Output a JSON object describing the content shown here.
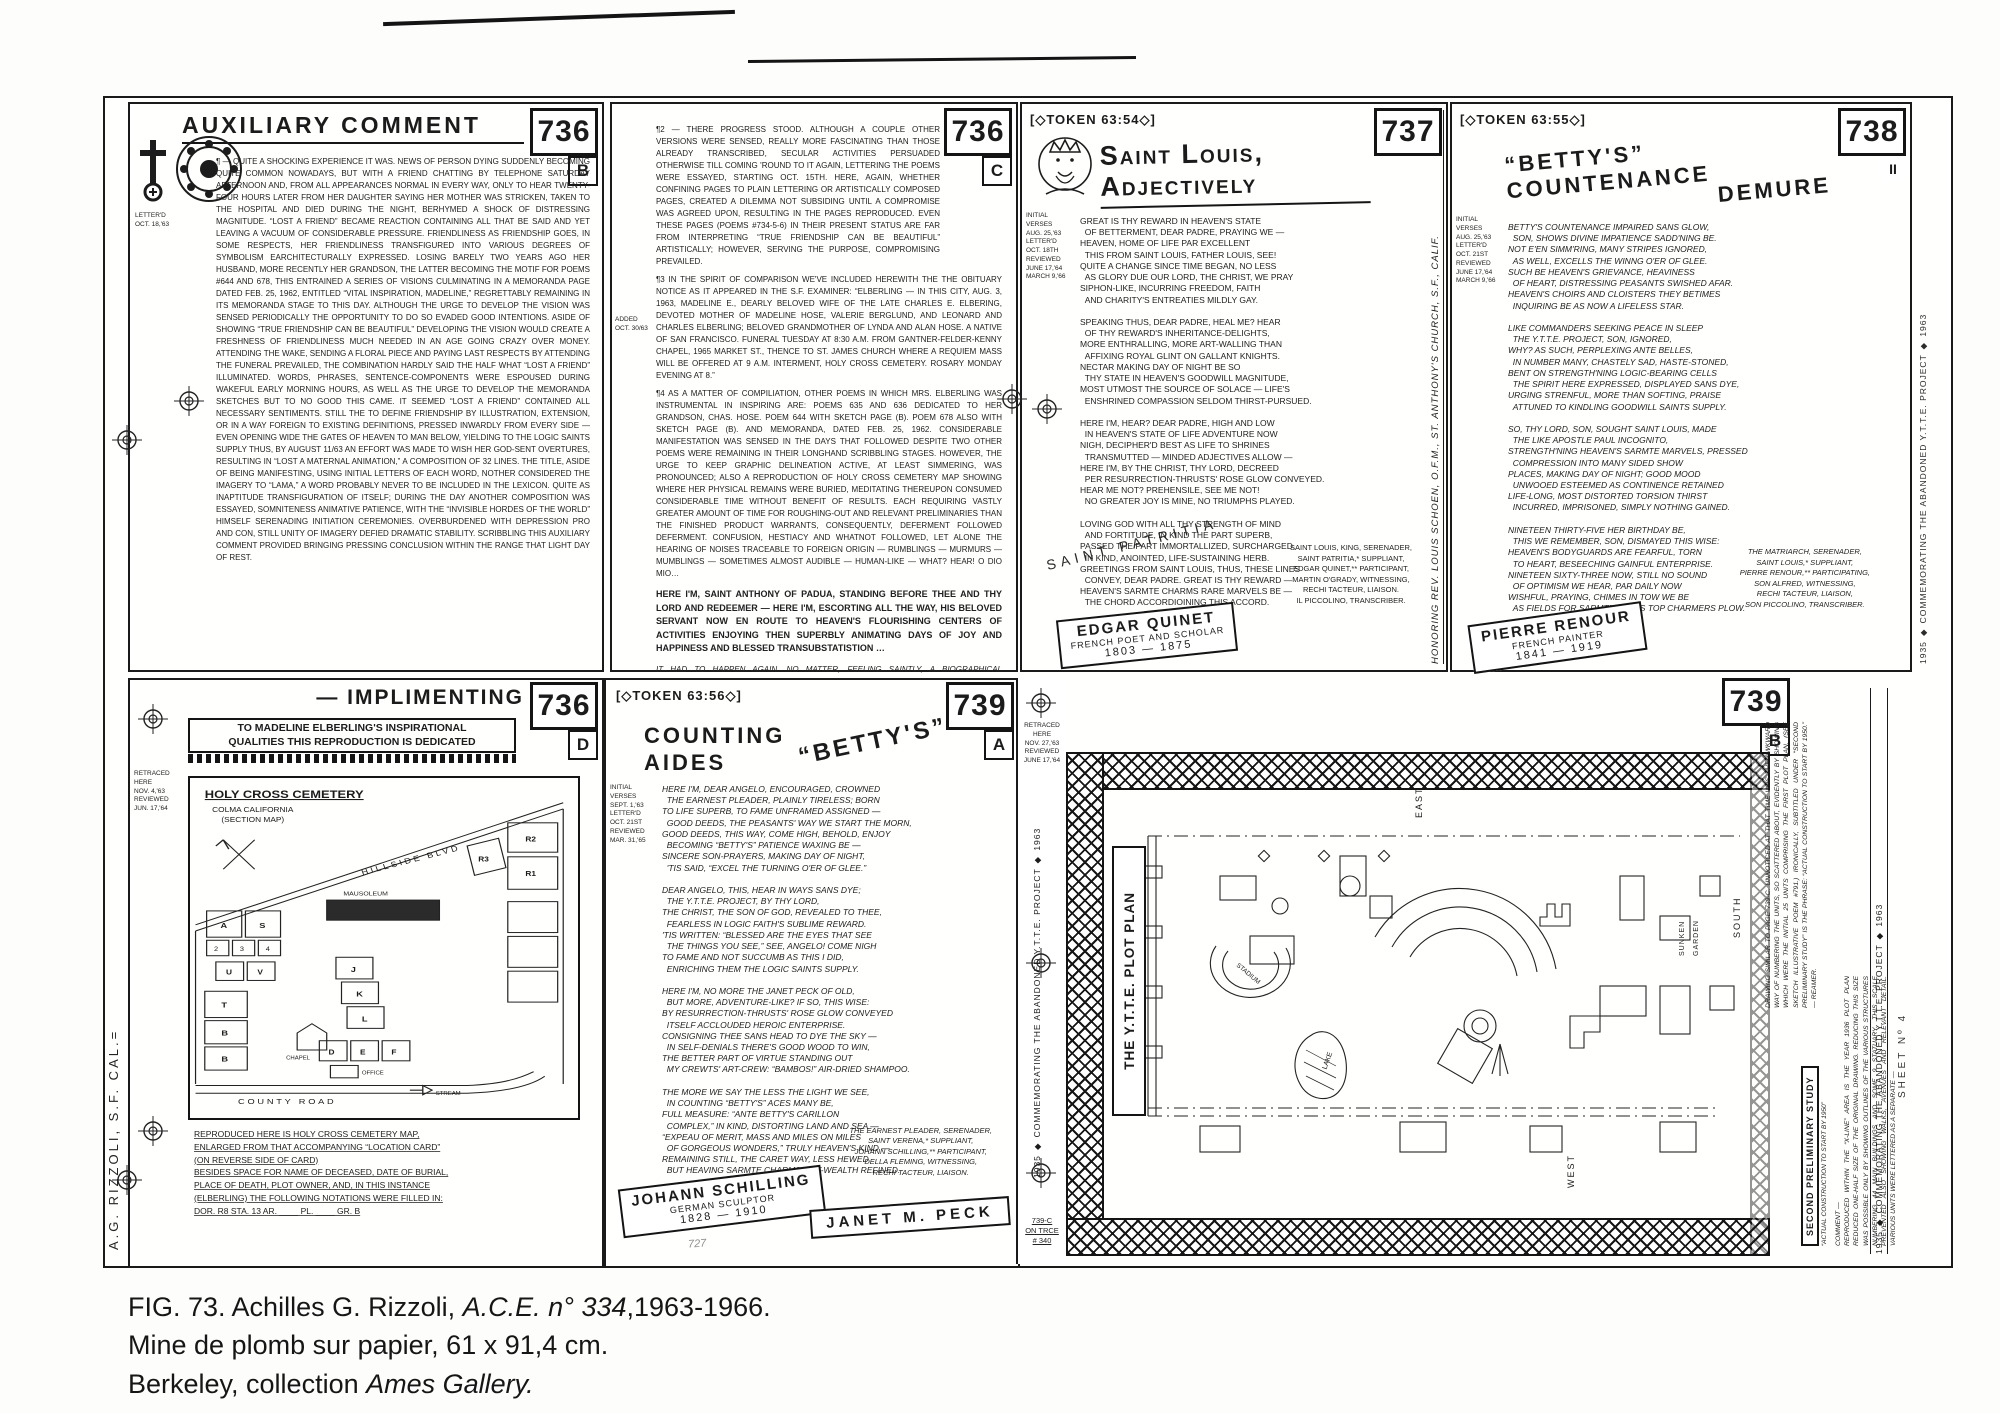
{
  "caption": {
    "line1_prefix": "FIG. 73. Achilles G. Rizzoli, ",
    "line1_italic": "A.C.E. n° 334",
    "line1_suffix": ",1963-1966.",
    "line2": "Mine de plomb sur papier, 61 x 91,4 cm.",
    "line3_prefix": "Berkeley, collection ",
    "line3_italic": "Ames Gallery."
  },
  "scan": {
    "artist_signature": "A.G. RIZZOLI, S.F. CAL.=",
    "pencil_note": "727"
  },
  "p736b": {
    "number": "736",
    "letter": "B",
    "title": "AUXILIARY COMMENT",
    "margin": "LETTER'D\nOCT. 18,'63",
    "body": "¶ — QUITE A SHOCKING EXPERIENCE IT WAS. NEWS OF PERSON DYING SUDDENLY BECOMING QUITE COMMON NOWADAYS, BUT WITH A FRIEND CHATTING BY TELEPHONE SATURDAY AFTERNOON AND, FROM ALL APPEARANCES NORMAL IN EVERY WAY, ONLY TO HEAR TWENTY-FOUR HOURS LATER FROM HER DAUGHTER SAYING HER MOTHER WAS STRICKEN, TAKEN TO THE HOSPITAL AND DIED DURING THE NIGHT, BERHYMED A SHOCK OF DISTRESSING MAGNITUDE. “LOST A FRIEND” BECAME REACTION CONTAINING ALL THAT BE SAID AND YET LEAVING A VACUUM OF CONSIDERABLE PRESSURE. FRIENDLINESS AS FRIENDSHIP GOES, IN SOME RESPECTS, HER FRIENDLINESS TRANSFIGURED INTO VARIOUS DEGREES OF SYMBOLISM EARCHITECTURALLY EXPRESSED. LOSING BARELY TWO YEARS AGO HER HUSBAND, MORE RECENTLY HER GRANDSON, THE LATTER BECOMING THE MOTIF FOR POEMS #644 AND 678, THIS ENTRAINED A SERIES OF VISIONS CULMINATING IN A MEMORANDA PAGE DATED FEB. 25, 1962, ENTITLED “VITAL INSPIRATION, MADELINE,” REGRETTABLY REMAINING IN ITS MEMORANDA STAGE TO THIS DAY. ALTHOUGH THE URGE TO DEVELOP THE VISION WAS SENSED PERIODICALLY THE OPPORTUNITY TO DO SO EVADED GOOD INTENTIONS. ASIDE OF SHOWING “TRUE FRIENDSHIP CAN BE BEAUTIFUL” DEVELOPING THE VISION WOULD CREATE A FRESHNESS OF FRIENDLINESS MUCH NEEDED IN AN AGE GOING CRAZY OVER MONEY. ATTENDING THE WAKE, SENDING A FLORAL PIECE AND PAYING LAST RESPECTS BY ATTENDING THE FUNERAL PREVAILED, THE COMBINATION HARDLY SAID THE HALF WHAT “LOST A FRIEND” ILLUMINATED. WORDS, PHRASES, SENTENCE-COMPONENTS WERE ESPOUSED DURING WAKEFUL EARLY MORNING HOURS, AS WELL AS THE URGE TO DEVELOP THE MEMORANDA SKETCHES BUT TO NO GOOD THIS CAME. IT SEEMED “LOST A FRIEND” CONTAINED ALL NECESSARY SENTIMENTS. STILL THE TO DEFINE FRIENDSHIP BY ILLUSTRATION, EXTENSION, OR IN A WAY FOREIGN TO EXISTING DEFINITIONS, PRESSED INWARDLY FROM EVERY SIDE — EVEN OPENING WIDE THE GATES OF HEAVEN TO MAN BELOW, YIELDING TO THE LOGIC SAINTS SUPPLY THUS, BY AUGUST 11/63 AN EFFORT WAS MADE TO WISH HER GOD-SENT OVERTURES, RESULTING IN “LOST A MATERNAL ANIMATION,” A COMPOSITION OF 32 LINES. THE TITLE, ASIDE OF BEING MANIFESTING, USING INITIAL LETTERS OF EACH WORD, NOTHER CONSIDERED THE IMAGERY TO “LAMA,” A WORD PROBABLY NEVER TO BE INCLUDED IN THE LEXICON. QUITE AS INAPTITUDE TRANSFIGURATION OF ITSELF; DURING THE DAY ANOTHER COMPOSITION WAS ESSAYED, SOMNITENESS ANIMATIVE PATIENCE, WITH THE “INVISIBLE HORDES OF THE WORLD” HIMSELF SERENADING INITIATION CEREMONIES. OVERBURDENED WITH DEPRESSION PRO AND CON, STILL UNITY OF IMAGERY DEFIED DRAMATIC STABILITY. SCRIBBLING THIS AUXILIARY COMMENT PROVIDED BRINGING PRESSING CONCLUSION WITHIN THE RANGE THAT LIGHT DAY OF REST."
  },
  "p736c": {
    "number": "736",
    "letter": "C",
    "margin": "ADDED\nOCT. 30/63",
    "para2": "¶2 — THERE PROGRESS STOOD. ALTHOUGH A COUPLE OTHER VERSIONS WERE SENSED, REALLY MORE FASCINATING THAN THOSE ALREADY TRANSCRIBED, SECULAR ACTIVITIES PERSUADED OTHERWISE TILL COMING 'ROUND TO IT AGAIN, LETTERING THE POEMS WERE ESSAYED, STARTING OCT. 15TH. HERE, AGAIN, WHETHER CONFINING PAGES TO PLAIN LETTERING OR ARTISTICALLY COMPOSED PAGES, CREATED A DILEMMA NOT SUBSIDING UNTIL A COMPROMISE WAS AGREED UPON, RESULTING IN THE PAGES REPRODUCED. EVEN THESE PAGES (POEMS #734-5-6) IN THEIR PRESENT STATUS ARE FAR FROM INTERPRETING “TRUE FRIENDSHIP CAN BE BEAUTIFUL” ARTISTICALLY; HOWEVER, SERVING THE PURPOSE, COMPROMISING PREVAILED.",
    "para3": "¶3 IN THE SPIRIT OF COMPARISON WE'VE INCLUDED HEREWITH THE THE OBITUARY NOTICE AS IT APPEARED IN THE S.F. EXAMINER: “ELBERLING — IN THIS CITY, AUG. 3, 1963, MADELINE E., DEARLY BELOVED WIFE OF THE LATE CHARLES E. ELBERING, DEVOTED MOTHER OF MADELINE HOSE, VALERIE BERGLUND, AND LEONARD AND CHARLES ELBERLING; BELOVED GRANDMOTHER OF LYNDA AND ALAN HOSE. A NATIVE OF SAN FRANCISCO. FUNERAL TUESDAY AT 8:30 A.M. FROM GANTNER-FELDER-KENNY CHAPEL, 1965 MARKET ST., THENCE TO ST. JAMES CHURCH WHERE A REQUIEM MASS WILL BE OFFERED AT 9 A.M. INTERMENT, HOLY CROSS CEMETERY. ROSARY MONDAY EVENING AT 8.”",
    "para4": "¶4 AS A MATTER OF COMPILIATION, OTHER POEMS IN WHICH MRS. ELBERLING WAS INSTRUMENTAL IN INSPIRING ARE: POEMS 635 AND 636 DEDICATED TO HER GRANDSON, CHAS. HOSE. POEM 644 WITH SKETCH PAGE (B). POEM 678 ALSO WITH SKETCH PAGE (B). AND MEMORANDA, DATED FEB. 25, 1962. CONSIDERABLE MANIFESTATION WAS SENSED IN THE DAYS THAT FOLLOWED DESPITE TWO OTHER POEMS WERE REMAINING IN THEIR LONGHAND SCRIBBLING STAGES. HOWEVER, THE URGE TO KEEP GRAPHIC DELINEATION ACTIVE, AT LEAST SIMMERING, WAS PRONOUNCED; ALSO A REPRODUCTION OF HOLY CROSS CEMETERY MAP SHOWING WHERE HER PHYSICAL REMAINS WERE BURIED, MEDITATING THEREUPON CONSUMED CONSIDERABLE TIME WITHOUT BENEFIT OF RESULTS. EACH REQUIRING VASTLY GREATER AMOUNT OF TIME FOR ROUGHING-OUT AND RELEVANT PRELIMINARIES THAN THE FINISHED PRODUCT WARRANTS, CONSEQUENTLY, DEFERMENT FOLLOWED DEFERMENT. CONFUSION, HESTIACY AND WHATNOT FOLLOWED, LET ALONE THE HEARING OF NOISES TRACEABLE TO FOREIGN ORIGIN — RUMBLINGS — MURMURS — MUMBLINGS — SOMETIMES ALMOST AUDIBLE — HUMAN-LIKE — WHAT? HEAR! O DIO MIO…",
    "anthony": "HERE I'M, SAINT ANTHONY OF PADUA, STANDING BEFORE THEE AND THY LORD AND REDEEMER — HERE I'M, ESCORTING ALL THE WAY, HIS BELOVED SERVANT NOW EN ROUTE TO HEAVEN'S FLOURISHING CENTERS OF ACTIVITIES ENJOYING THEN SUPERBLY ANIMATING DAYS OF JOY AND HAPPINESS AND BLESSED TRANSUBSTATISTION …",
    "agapitus": "IT HAD TO HAPPEN AGAIN. NO MATTER, FEELING SAINTLY, A BIOGRAPHICAL PARAGRAPH OF SAINT AGAPITUS FOLLOWS: “AGAPITUS (3) M. R.M. AUG. 18. d. c. 274. A BOY OF FIFTEEN WHO BRAVELY CONFESSED CHRIST AND WAS MARTYRED AT PALESTRINA, WHERE AS EARLY AS THE 5TH CENT. A CHURCH WAS DEDICATED TO HIM BY POPE FELIX III (483-492).”",
    "source": "FROM THE BOOK OF SAINTS (MACMILLAN)"
  },
  "p737": {
    "token": "[◇TOKEN 63:54◇]",
    "title": "Saint Louis, Adjectively",
    "number": "737",
    "margin": "INITIAL\nVERSES\nAUG. 25,'63\nLETTER'D\nOCT. 18TH\nREVIEWED\nJUNE 17,'64\nMARCH 9,'66",
    "poem": "GREAT IS THY REWARD IN HEAVEN'S STATE\n  OF BETTERMENT, DEAR PADRE, PRAYING WE —\nHEAVEN, HOME OF LIFE PAR EXCELLENT\n  THIS FROM SAINT LOUIS, FATHER LOUIS, SEE!\nQUITE A CHANGE SINCE TIME BEGAN, NO LESS\n  AS GLORY DUE OUR LORD, THE CHRIST, WE PRAY\nSIPHON-LIKE, INCURRING FREEDOM, FAITH\n  AND CHARITY'S ENTREATIES MILDLY GAY.\n\nSPEAKING THUS, DEAR PADRE, HEAL ME? HEAR\n  OF THY REWARD'S INHERITANCE-DELIGHTS,\nMORE ENTHRALLING, MORE ART-WALLING THAN\n  AFFIXING ROYAL GLINT ON GALLANT KNIGHTS.\nNECTAR MAKING DAY OF NIGHT BE SO\n  THY STATE IN HEAVEN'S GOODWILL MAGNITUDE,\nMOST UTMOST THE SOURCE OF SOLACE — LIFE'S\n  ENSHRINED COMPASSION SELDOM THIRST-PURSUED.\n\nHERE I'M, HEAR? DEAR PADRE, HIGH AND LOW\n  IN HEAVEN'S STATE OF LIFE ADVENTURE NOW\nNIGH, DECIPHER'D BEST AS LIFE TO SHRINES\n  TRANSMUTTED — MINDED ADJECTIVES ALLOW —\nHERE I'M, BY THE CHRIST, THY LORD, DECREED\n  PER RESURRECTION-THRUSTS' ROSE GLOW CONVEYED.\nHEAR ME NOT? PREHENSILE, SEE ME NOT!\n  NO GREATER JOY IS MINE, NO TRIUMPHS PLAYED.\n\nLOVING GOD WITH ALL THY STRENGTH OF MIND\n  AND FORTITUDE, IN KIND THE PART SUPERB,\nPASSED THE PART IMMORTALLIZED, SURCHARGED,\n  IN KIND, ANOINTED, LIFE-SUSTAINING HERB.\nGREETINGS FROM SAINT LOUIS, THUS, THESE LINES\n  CONVEY, DEAR PADRE. GREAT IS THY REWARD —\nHEAVEN'S SARMTE CHARMS RARE MARVELS BE —\n  THE CHORD ACCORDIOINING THIS ACCORD.",
    "credits": "SAINT LOUIS, KING, SERENADER,\nSAINT PATRITIA,* SUPPLIANT,\nEDGAR QUINET,** PARTICIPANT,\nMARTIN O'GRADY, WITNESSING,\nRECHI TACTEUR, LIAISON.\nIL PICCOLINO, TRANSCRIBER.",
    "diagonal": "SAINT PATRITIA",
    "label_name": "EDGAR QUINET",
    "label_role": "FRENCH POET AND SCHOLAR",
    "label_years": "1803 — 1875",
    "vertical": "HONORING REV. LOUIS SCHOEN, O.F.M., ST. ANTHONY'S CHURCH, S.F., CALIF."
  },
  "p738": {
    "token": "[◇TOKEN 63:55◇]",
    "title_line1": "“BETTY'S” COUNTENANCE",
    "title_line2": "DEMURE",
    "number": "738",
    "ditto": "II",
    "margin": "INITIAL\nVERSES\nAUG. 25,'63\nLETTER'D\nOCT. 21ST\nREVIEWED\nJUNE 17,'64\nMARCH 9,'66",
    "poem": "BETTY'S COUNTENANCE IMPAIRED SANS GLOW,\n  SON, SHOWS DIVINE IMPATIENCE SADD'NING BE.\nNOT E'EN SIMM'RING, MANY STRIPES IGNORED,\n  AS WELL, EXCELLS THE WINNG O'ER OF GLEE.\nSUCH BE HEAVEN'S GRIEVANCE, HEAVINESS\n  OF HEART, DISTRESSING PEASANTS SWISHED AFAR.\nHEAVEN'S CHOIRS AND CLOISTERS THEY BETIMES\n  INQUIRING BE AS NOW A LIFELESS STAR.\n\nLIKE COMMANDERS SEEKING PEACE IN SLEEP\n  THE Y.T.T.E. PROJECT, SON, IGNORED,\nWHY? AS SUCH, PERPLEXING ANTE BELLES,\n  IN NUMBER MANY, CHASTELY SAD, HASTE-STONED,\nBENT ON STRENGTH'NING LOGIC-BEARING CELLS\n  THE SPIRIT HERE EXPRESSED, DISPLAYED SANS DYE,\nURGING STRENFUL, MORE THAN SOFTING, PRAISE\n  ATTUNED TO KINDLING GOODWILL SAINTS SUPPLY.\n\nSO, THY LORD, SON, SOUGHT SAINT LOUIS, MADE\n  THE LIKE APOSTLE PAUL INCOGNITO,\nSTRENGTH'NING HEAVEN'S SARMTE MARVELS, PRESSED\n  COMPRESSION INTO MANY SIDED SHOW\nPLACES, MAKING DAY OF NIGHT; GOOD MOOD\n  UNWOOED ESTEEMED AS CONTINENCE RETAINED\nLIFE-LONG, MOST DISTORTED TORSION THIRST\n  INCURRED, IMPRISONED, SIMPLY NOTHING GAINED.\n\nNINETEEN THIRTY-FIVE HER BIRTHDAY BE,\n  THIS WE REMEMBER, SON, DISMAYED THIS WISE:\nHEAVEN'S BODYGUARDS ARE FEARFUL, TORN\n  TO HEART, BESEECHING GAINFUL ENTERPRISE.\nNINETEEN SIXTY-THREE NOW, STILL NO SOUND\n  OF OPTIMISM WE HEAR, PAR DAILY NOW\nWISHFUL, PRAYING, CHIMES IN TOW WE BE\n  AS FIELDS FOR SARMTE BALMS TOP CHARMERS PLOW.",
    "credits": "THE MATRIARCH, SERENADER,\nSAINT LOUIS,* SUPPLIANT,\nPIERRE RENOUR,** PARTICIPATING,\nSON ALFRED, WITNESSING,\nRECHI TACTEUR, LIAISON,\nSON PICCOLINO, TRANSCRIBER.",
    "label_name": "PIERRE RENOUR",
    "label_role": "FRENCH PAINTER",
    "label_years": "1841 — 1919",
    "edge_vertical": "1935 ◆ COMMEMORATING THE ABANDONED Y.T.T.E. PROJECT ◆ 1963"
  },
  "p736d": {
    "title": "— IMPLIMENTING",
    "number": "736",
    "letter": "D",
    "dedication": "TO MADELINE ELBERLING'S INSPIRATIONAL\nQUALITIES THIS REPRODUCTION IS DEDICATED",
    "margin_top": "RETRACED\nHERE\nNOV. 4,'63\nREVIEWED\nJUN. 17,'64",
    "map": {
      "title": "HOLY CROSS CEMETERY",
      "subtitle": "COLMA   CALIFORNIA",
      "note": "(SECTION MAP)",
      "road": "HILLSIDE  BLVD",
      "county_road": "COUNTY  ROAD",
      "stream": "STREAM",
      "mausoleum": "MAUSOLEUM",
      "chapel": "CHAPEL",
      "office": "OFFICE",
      "sections": [
        "R3",
        "R2",
        "R1",
        "A",
        "S",
        "2",
        "3",
        "4",
        "U",
        "V",
        "T",
        "B",
        "B",
        "J",
        "K",
        "L",
        "D",
        "E",
        "F"
      ]
    },
    "bottom": "REPRODUCED HERE IS HOLY CROSS CEMETERY MAP,\nENLARGED FROM THAT ACCOMPANYING “LOCATION CARD”\n(ON REVERSE SIDE OF CARD)\nBESIDES SPACE FOR NAME OF DECEASED, DATE OF BURIAL,\nPLACE OF DEATH, PLOT OWNER, AND, IN THIS INSTANCE\n(ELBERLING) THE FOLLOWING NOTATIONS WERE FILLED IN:\nDOR. R8     STA. 13     AR. ____     PL. ____     GR. B"
  },
  "p739a": {
    "token": "[◇TOKEN 63:56◇]",
    "title_pre": "COUNTING",
    "title_mid": "“BETTY'S”",
    "title_post": "AIDES",
    "number": "739",
    "letter": "A",
    "margin": "INITIAL\nVERSES\nSEPT. 1,'63\nLETTER'D\nOCT. 21ST\nREVIEWED\nMAR. 31,'65",
    "poem": "HERE I'M, DEAR ANGELO, ENCOURAGED, CROWNED\n  THE EARNEST PLEADER, PLAINLY TIRELESS; BORN\nTO LIFE SUPERB, TO FAME UNFRAMED ASSIGNED —\n  GOOD DEEDS, THE PEASANTS' WAY WE START THE MORN,\nGOOD DEEDS, THIS WAY, COME HIGH, BEHOLD, ENJOY\n  BECOMING “BETTY'S” PATIENCE WAXING BE —\nSINCERE SON-PRAYERS, MAKING DAY OF NIGHT,\n  'TIS SAID, “EXCEL THE TURNING O'ER OF GLEE.”\n\nDEAR ANGELO, THIS, HEAR IN WAYS SANS DYE;\n  THE Y.T.T.E. PROJECT, BY THY LORD,\nTHE CHRIST, THE SON OF GOD, REVEALED TO THEE,\n  FEARLESS IN LOGIC FAITH'S SUBLIME REWARD.\n'TIS WRITTEN: “BLESSED ARE THE EYES THAT SEE\n  THE THINGS YOU SEE,” SEE, ANGELO! COME NIGH\nTO FAME AND NOT SUCCUMB AS THIS I DID,\n  ENRICHING THEM THE LOGIC SAINTS SUPPLY.\n\nHERE I'M, NO MORE THE JANET PECK OF OLD,\n  BUT MORE, ADVENTURE-LIKE? IF SO, THIS WISE:\nBY RESURRECTION-THRUSTS' ROSE GLOW CONVEYED\n  ITSELF ACCLOUDED HEROIC ENTERPRISE.\nCONSIGNING THEE SANS HEAD TO DYE THE SKY —\n  IN SELF-DENIALS THERE'S GOOD WOOD TO WIN,\nTHE BETTER PART OF VIRTUE STANDING OUT\n  MY CREWTS' ART-CREW: “BAMBOS!” AIR-DRIED SHAMPOO.\n\nTHE MORE WE SAY THE LESS THE LIGHT WE SEE,\n  IN COUNTING “BETTY'S” ACES MANY BE,\nFULL MEASURE: “ANTE BETTY'S CARILLON\n  COMPLEX,” IN KIND, DISTORTING LAND AND SEA —\n“EXPEAU OF MERIT, MASS AND MILES ON MILES\n  OF GORGEOUS WONDERS,” TRULY HEAVEN'S KIND —\nREMAINING STILL, THE CARET WAY, LESS HEWED\n  BUT HEAVING SARMTE CHARMS' ART-WEALTH REFINED.",
    "credits": "THE EARNEST PLEADER, SERENADER,\nSAINT VERENA,* SUPPLIANT,\nJOHANN SCHILLING,** PARTICIPANT,\nDELLA FLEMING, WITNESSING,\nRECHI TACTEUR, LIAISON.",
    "label1_name": "JOHANN SCHILLING",
    "label1_role": "GERMAN SCULPTOR",
    "label1_years": "1828 — 1910",
    "label2_name": "JANET M. PECK"
  },
  "strip739": {
    "top_note": "RETRACED\nHERE\nNOV. 27,'63\nREVIEWED\nJUNE 17,'64",
    "vertical": "1935 ◆ COMMEMORATING THE ABANDONED Y.T.T.E. PROJECT ◆ 1963",
    "bottom_note": "739-C\nON TRCE\n# 340"
  },
  "p739b": {
    "number": "739",
    "letter": "B",
    "plan_label": "THE Y.T.T.E. PLOT PLAN",
    "east": "EAST",
    "north": "NORTH",
    "west": "WEST",
    "south": "SOUTH",
    "stadium": "STADIUM",
    "sunken1": "SUNKEN",
    "sunken2": "GARDEN",
    "lake": "LAKE",
    "note": "DRAWING SIMILAR TO PAGE 739-C. UNNOTICED AT THAT TIME WAS THE AWKWARD WAY OF NUMBERING THE UNITS, SO SCATTERED ABOUT, EVIDENTLY BY SHOWING WHICH WERE THE INITIAL 25 UNITS COMPRISING THE FIRST PLOT PLAN. (SEE SKETCH ILLUSTRATIVE POEM #791.) IRONICALLY, SUBTITLED UNDER “SECOND PRELIMINARY STUDY” IS THE PHRASE: “ACTUAL CONSTRUCTION TO START BY 1950.” — REAMER.",
    "study_label": "SECOND PRELIMINARY STUDY",
    "study_sub": "“ACTUAL CONSTRUCTION TO START BY 1950”",
    "comment": "COMMENT —\nREPRODUCED WITHIN THE “X-LINE” AREA IS THE YEAR 1936 PLOT PLAN REDUCED ONE-HALF SIZE OF THE ORIGINAL DRAWING. REDUCING THIS SIZE WAS POSSIBLE ONLY BY SHOWING OUTLINES OF THE VARIOUS STRUCTURES NUMBERING 44 MAIN BUILDINGS AND SOME 9 STATUARY. THIS SCALE PREVENTED ALSO SHOWING WALKS, AVENUES AND RELEVANT DETAIL. VARIOUS UNITS WERE LETTERED AS A SEPARATE —",
    "edge_vertical": "1935 ◆ COMMEMORATING THE ABANDONED Y.T.T.E. PROJECT ◆ 1963",
    "sheet_no": "SHEET Nº 4"
  }
}
